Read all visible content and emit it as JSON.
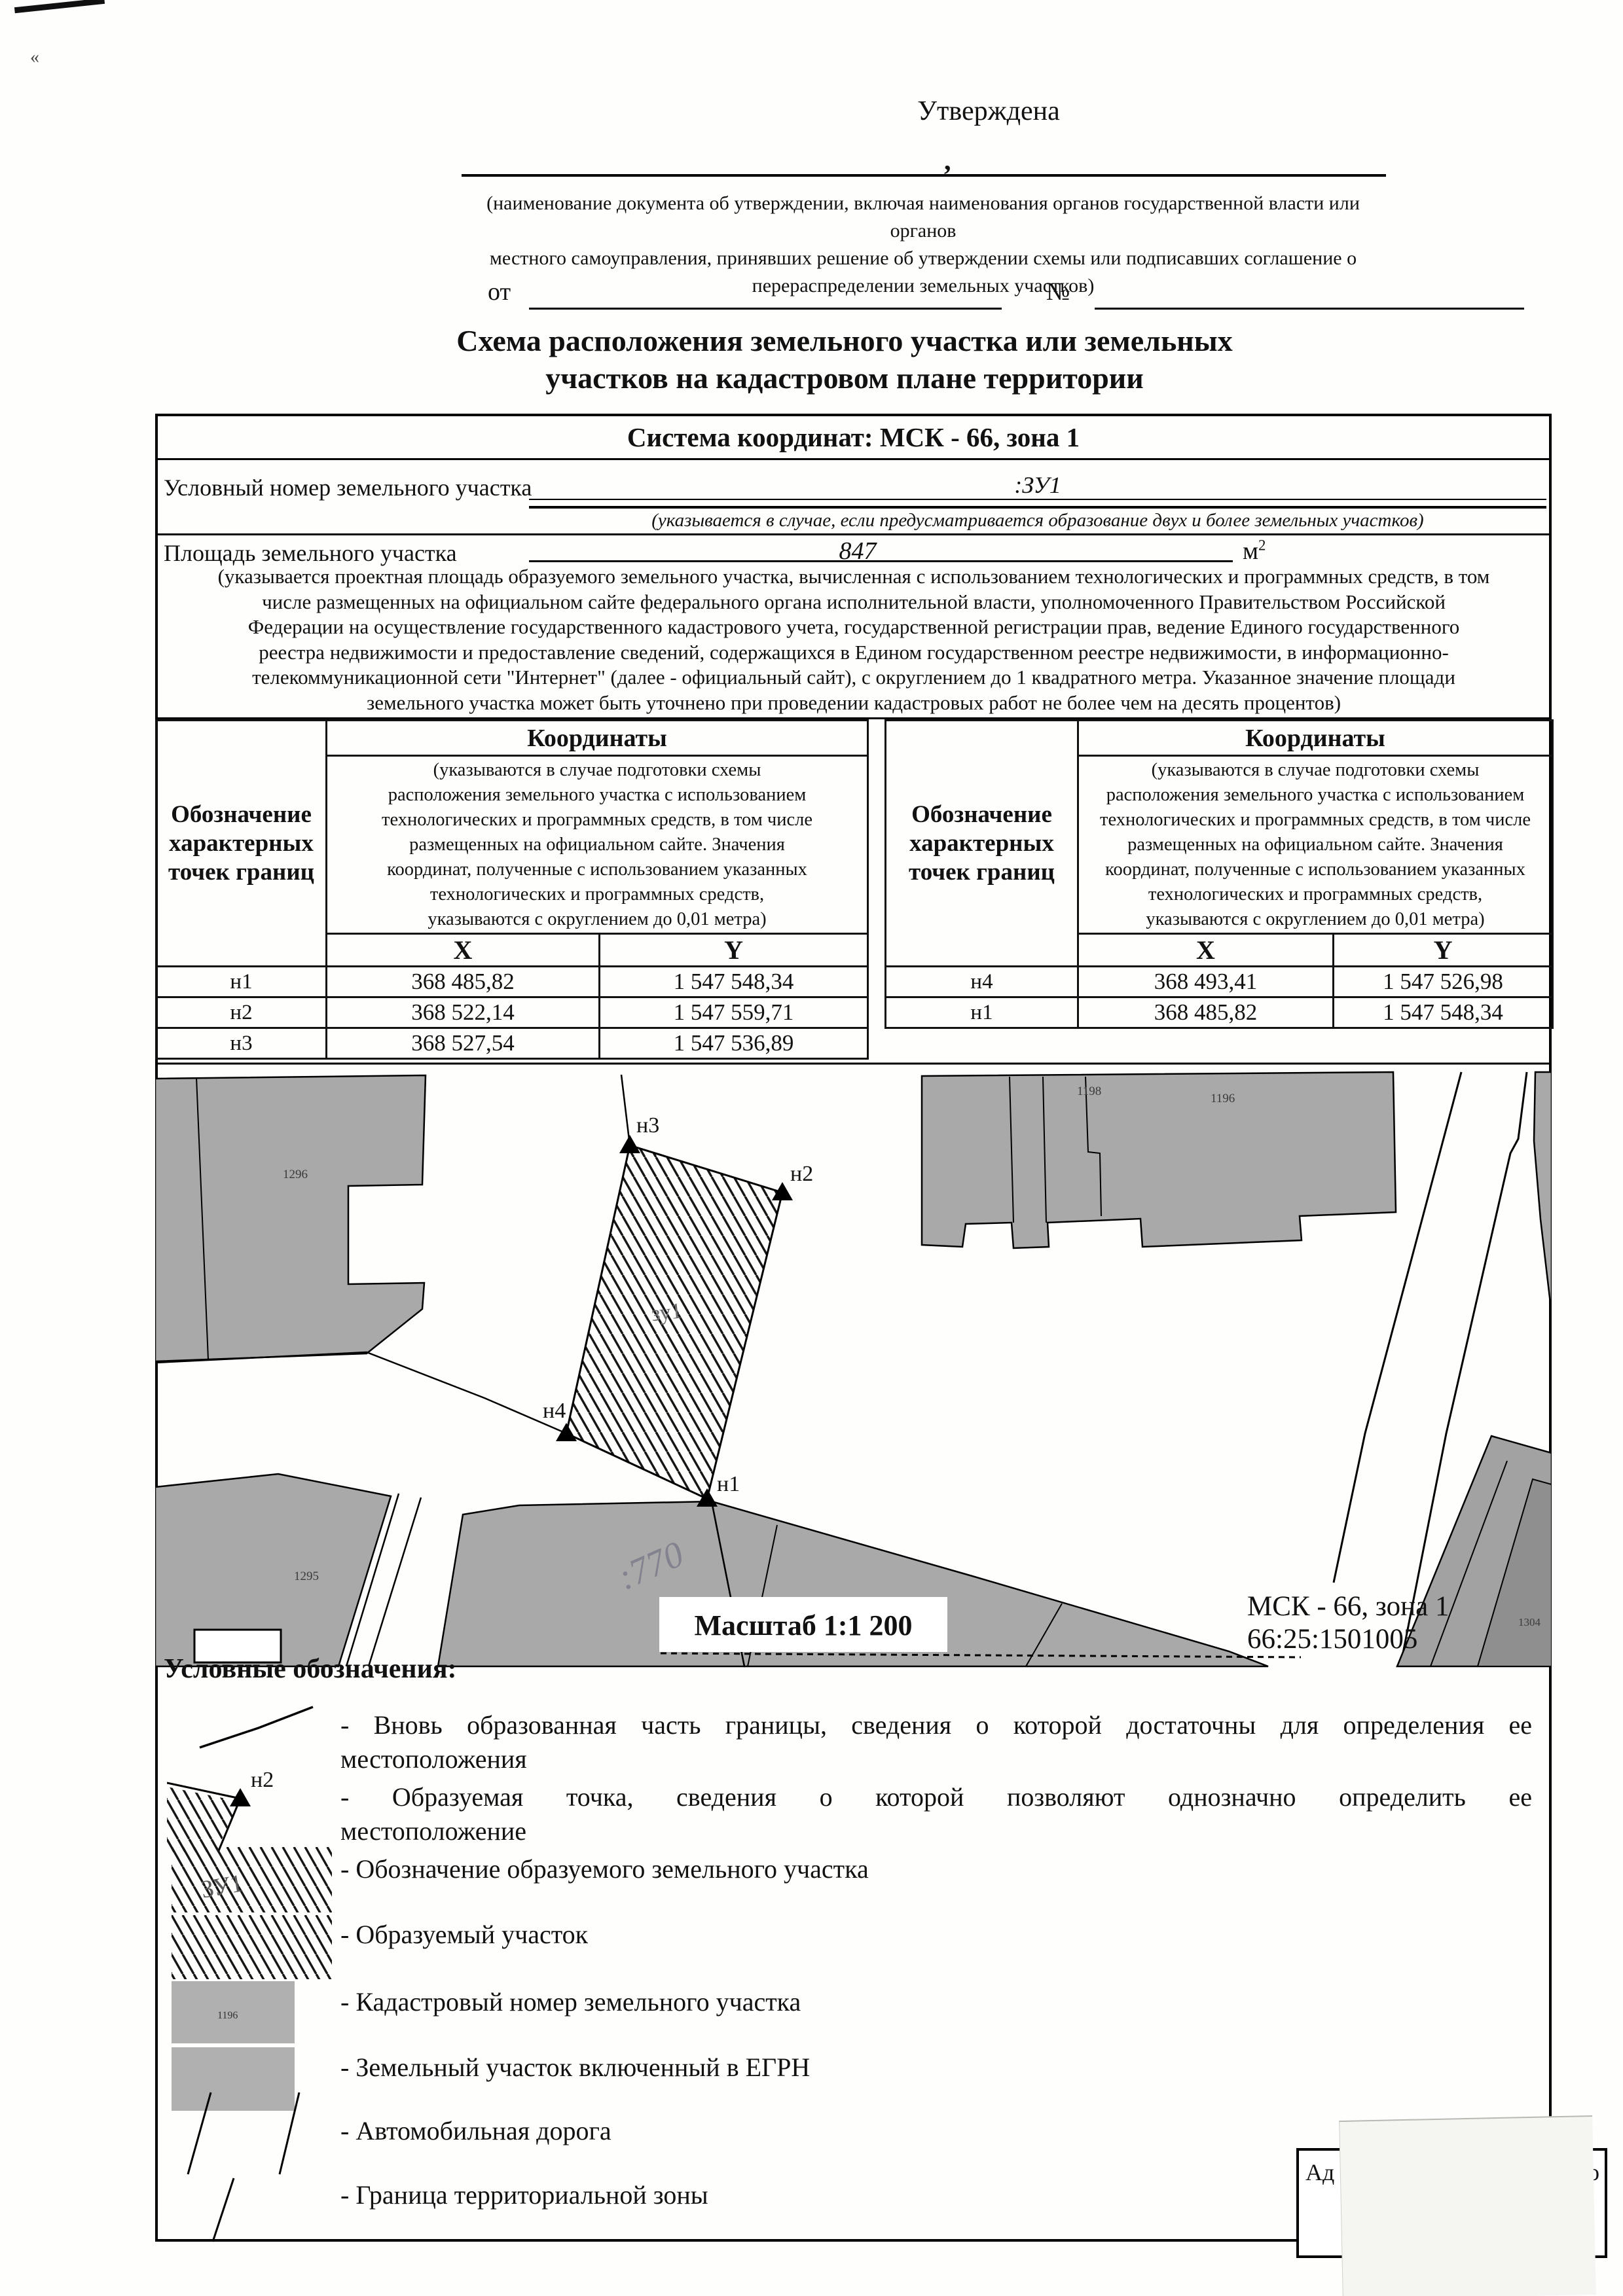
{
  "header": {
    "corner_mark": "«",
    "approved": "Утверждена",
    "comma": ",",
    "note_lines": [
      "(наименование документа об утверждении, включая наименования органов государственной власти или органов",
      "местного самоуправления, принявших решение об утверждении схемы или подписавших соглашение о",
      "перераспределении земельных участков)"
    ],
    "from_label": "от",
    "no_label": "№",
    "title_line1": "Схема расположения земельного участка или земельных",
    "title_line2": "участков на кадастровом плане территории"
  },
  "info": {
    "coord_system": "Система координат: МСК - 66, зона 1",
    "cond_label": "Условный номер земельного участка",
    "cond_value": ":ЗУ1",
    "cond_note": "(указывается в случае, если предусматривается образование двух и более земельных участков)",
    "area_label": "Площадь земельного участка",
    "area_value": "847",
    "area_unit_base": "м",
    "area_unit_sup": "2",
    "area_note_lines": [
      "(указывается проектная площадь образуемого земельного участка, вычисленная с использованием технологических и программных средств, в том",
      "числе размещенных на официальном сайте федерального органа исполнительной власти, уполномоченного Правительством Российской",
      "Федерации на осуществление государственного кадастрового учета, государственной регистрации прав, ведение Единого государственного",
      "реестра недвижимости и предоставление сведений, содержащихся в Едином государственном реестре недвижимости, в информационно-",
      "телекоммуникационной сети \"Интернет\" (далее - официальный сайт), с округлением до 1 квадратного метра. Указанное значение площади",
      "земельного участка может быть уточнено при проведении кадастровых работ не более чем на десять процентов)"
    ]
  },
  "coords": {
    "designation_lines": [
      "Обозначение",
      "характерных",
      "точек границ"
    ],
    "coords_label": "Координаты",
    "note_lines": [
      "(указываются в случае подготовки схемы",
      "расположения земельного участка с использованием",
      "технологических и программных средств, в том числе",
      "размещенных на официальном сайте. Значения",
      "координат, полученные с использованием указанных",
      "технологических и программных средств,",
      "указываются с округлением до 0,01 метра)"
    ],
    "x": "X",
    "y": "Y",
    "left_rows": [
      {
        "p": "н1",
        "x": "368 485,82",
        "y": "1 547 548,34"
      },
      {
        "p": "н2",
        "x": "368 522,14",
        "y": "1 547 559,71"
      },
      {
        "p": "н3",
        "x": "368 527,54",
        "y": "1 547 536,89"
      }
    ],
    "right_rows": [
      {
        "p": "н4",
        "x": "368 493,41",
        "y": "1 547 526,98"
      },
      {
        "p": "н1",
        "x": "368 485,82",
        "y": "1 547 548,34"
      }
    ]
  },
  "map": {
    "scale": "Масштаб 1:1 200",
    "zone": "МСК - 66, зона 1",
    "quarter": "66:25:1501005",
    "plot": "зу1",
    "p1": "н1",
    "p2": "н2",
    "p3": "н3",
    "p4": "н4",
    "num_tl": "1296",
    "num_tr1": "1198",
    "num_tr2": "1196",
    "num_bl": "1295",
    "num_br": "1304",
    "handwritten": ":770"
  },
  "legend": {
    "heading": "Условные обозначения:",
    "item1_l1": "- Вновь образованная часть границы, сведения о которой достаточны для определения ее",
    "item1_l2": "местоположения",
    "item2_l1": "- Образуемая точка, сведения о которой позволяют однозначно определить ее",
    "item2_l2": "местоположение",
    "item2_sym": "н2",
    "item3": "- Обозначение образуемого земельного участка",
    "item3_sym": "ЗУ1",
    "item4": "- Образуемый участок",
    "item5": "- Кадастровый номер земельного участка",
    "item5_sym": "1196",
    "item6": "- Земельный участок включенный в ЕГРН",
    "item7": "- Автомобильная дорога",
    "item8": "- Граница территориальной зоны"
  },
  "stamp": {
    "left": "Ад",
    "right": "го"
  }
}
